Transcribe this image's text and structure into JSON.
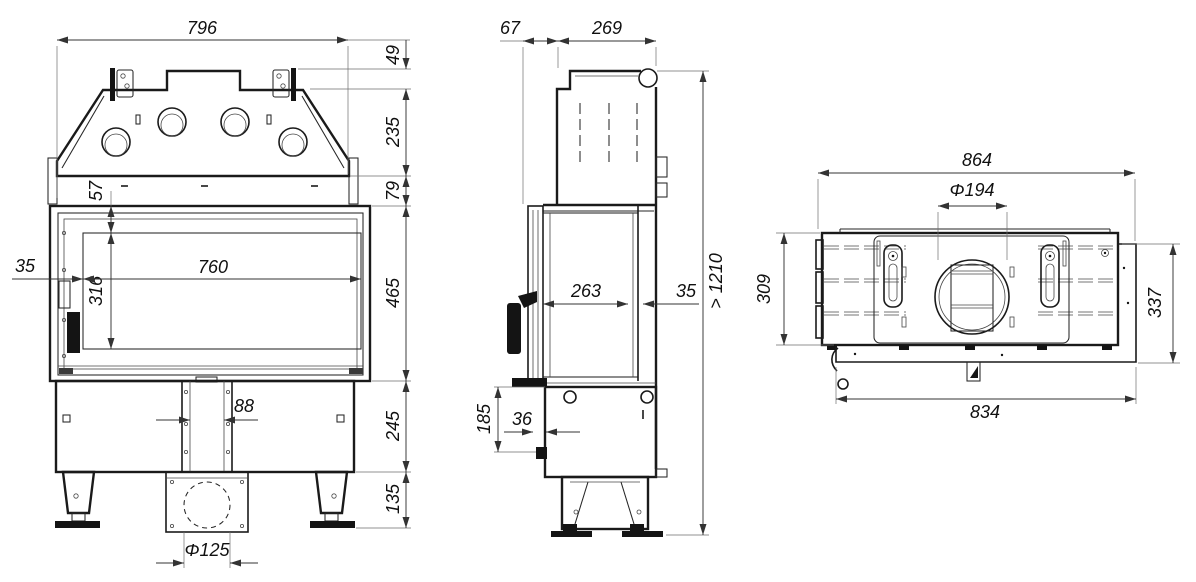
{
  "drawing_title": "fireplace-insert-dimension-drawing",
  "colors": {
    "background": "#ffffff",
    "line": "#1a1a1a",
    "dimension": "#333333"
  },
  "front_view": {
    "overall_width": "796",
    "top_flange_height": "49",
    "hood_height": "235",
    "hood_to_door_gap": "79",
    "glass_top_inset": "57",
    "left_inset": "35",
    "glass_width": "760",
    "glass_height": "316",
    "door_height": "465",
    "base_height": "245",
    "feet_height": "135",
    "duct_width": "88",
    "air_inlet_diameter": "Φ125"
  },
  "side_view": {
    "front_offset": "67",
    "top_depth": "269",
    "firebox_depth": "263",
    "rear_inset": "35",
    "min_total_height": "> 1210",
    "base_rear_height": "185",
    "front_step_depth": "36"
  },
  "top_view": {
    "overall_width": "864",
    "flue_diameter": "Φ194",
    "body_depth": "309",
    "overall_depth": "337",
    "frame_width": "834"
  }
}
